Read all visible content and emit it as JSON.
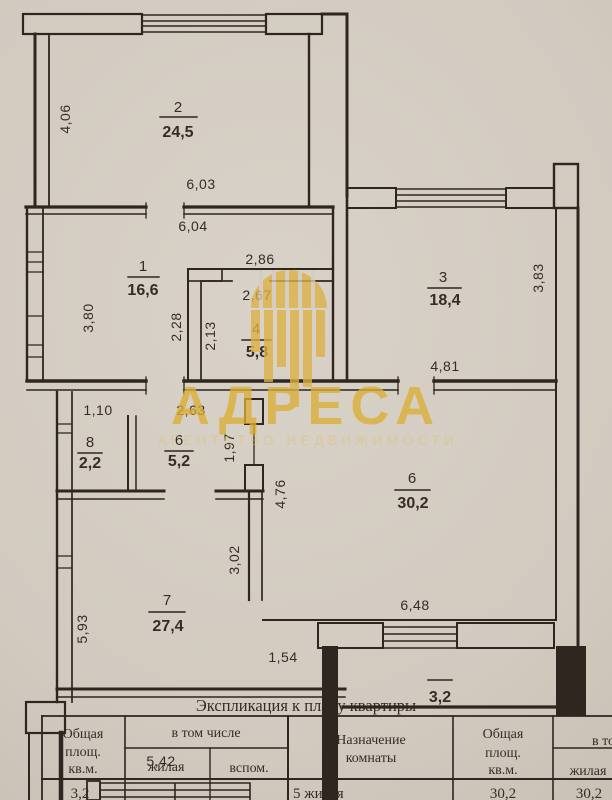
{
  "watermark": {
    "brand": "АДРЕСА",
    "tagline": "АГЕНТСТВО НЕДВИЖИМОСТИ",
    "color": "#dcae35"
  },
  "plan": {
    "rooms": [
      {
        "id": "room-2",
        "number": "2",
        "area": "24,5"
      },
      {
        "id": "room-1",
        "number": "1",
        "area": "16,6"
      },
      {
        "id": "room-3",
        "number": "3",
        "area": "18,4"
      },
      {
        "id": "room-4",
        "number": "4",
        "area": "5,8"
      },
      {
        "id": "room-8",
        "number": "8",
        "area": "2,2"
      },
      {
        "id": "room-6-small",
        "number": "6",
        "area": "5,2"
      },
      {
        "id": "room-6-large",
        "number": "6",
        "area": "30,2"
      },
      {
        "id": "room-7",
        "number": "7",
        "area": "27,4"
      },
      {
        "id": "balcony",
        "number": "",
        "area": "3,2"
      }
    ],
    "dimensions": {
      "room2_height": "4,06",
      "room2_width": "6,03",
      "room1_width": "6,04",
      "room1_height": "3,80",
      "room1_inner_height": "2,28",
      "room4_outer_width": "2,86",
      "room4_width": "2,67",
      "room4_height": "2,13",
      "room3_height": "3,83",
      "room3_width": "4,81",
      "room8_width": "1,10",
      "room6s_width": "2,63",
      "room6s_height": "1,97",
      "room6_height": "4,76",
      "room6_width": "6,48",
      "room7_right_height": "3,02",
      "room7_height": "5,93",
      "balcony_door_width": "1,54",
      "lower_width": "5,42"
    }
  },
  "table": {
    "title": "Экспликация к плану квартиры",
    "left": {
      "total_area_lines": [
        "Общая",
        "площ.",
        "кв.м."
      ],
      "including": "в том числе",
      "living": "жилая",
      "aux": "вспом.",
      "row_total": "3,2"
    },
    "right": {
      "purpose_lines": [
        "Назначение",
        "комнаты"
      ],
      "total_area_lines": [
        "Общая",
        "площ.",
        "кв.м."
      ],
      "including": "в том числе",
      "living": "жилая",
      "row_purpose": "5 жилая",
      "row_total": "30,2",
      "row_living": "30,2"
    }
  }
}
